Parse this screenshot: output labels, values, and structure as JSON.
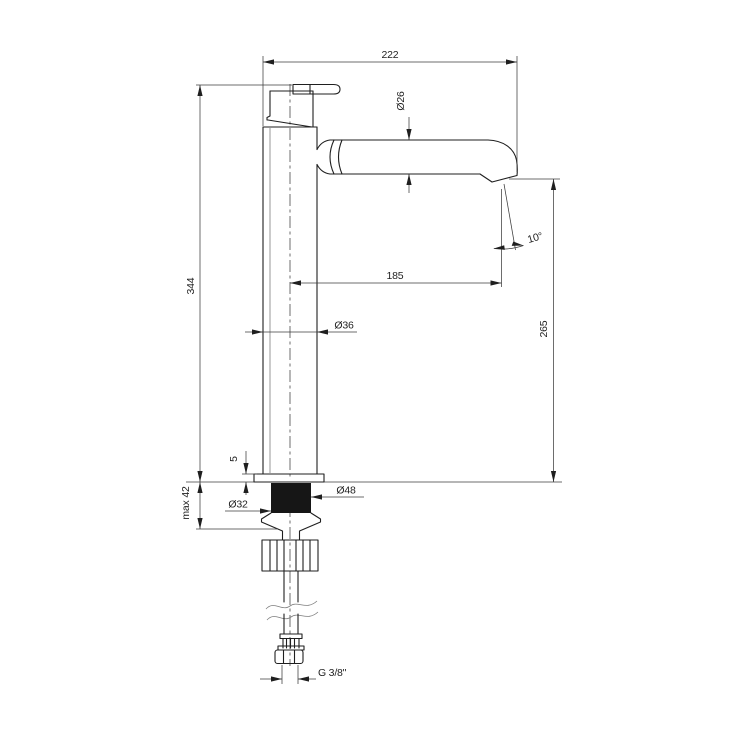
{
  "colors": {
    "background": "#ffffff",
    "object_line": "#1f1f1f",
    "dimension_line": "#3c3c3c",
    "gasket_fill": "#161616"
  },
  "drawing": {
    "dimensions": {
      "spout_reach": "222",
      "spout_tube_diameter": "Ø26",
      "total_height": "344",
      "spout_projection": "185",
      "outlet_angle": "10°",
      "body_diameter": "Ø36",
      "outlet_height": "265",
      "base_plate_height": "5",
      "max_mounting_thickness": "max 42",
      "base_diameter": "Ø48",
      "shank_diameter": "Ø32",
      "supply_thread": "G 3/8\""
    }
  }
}
